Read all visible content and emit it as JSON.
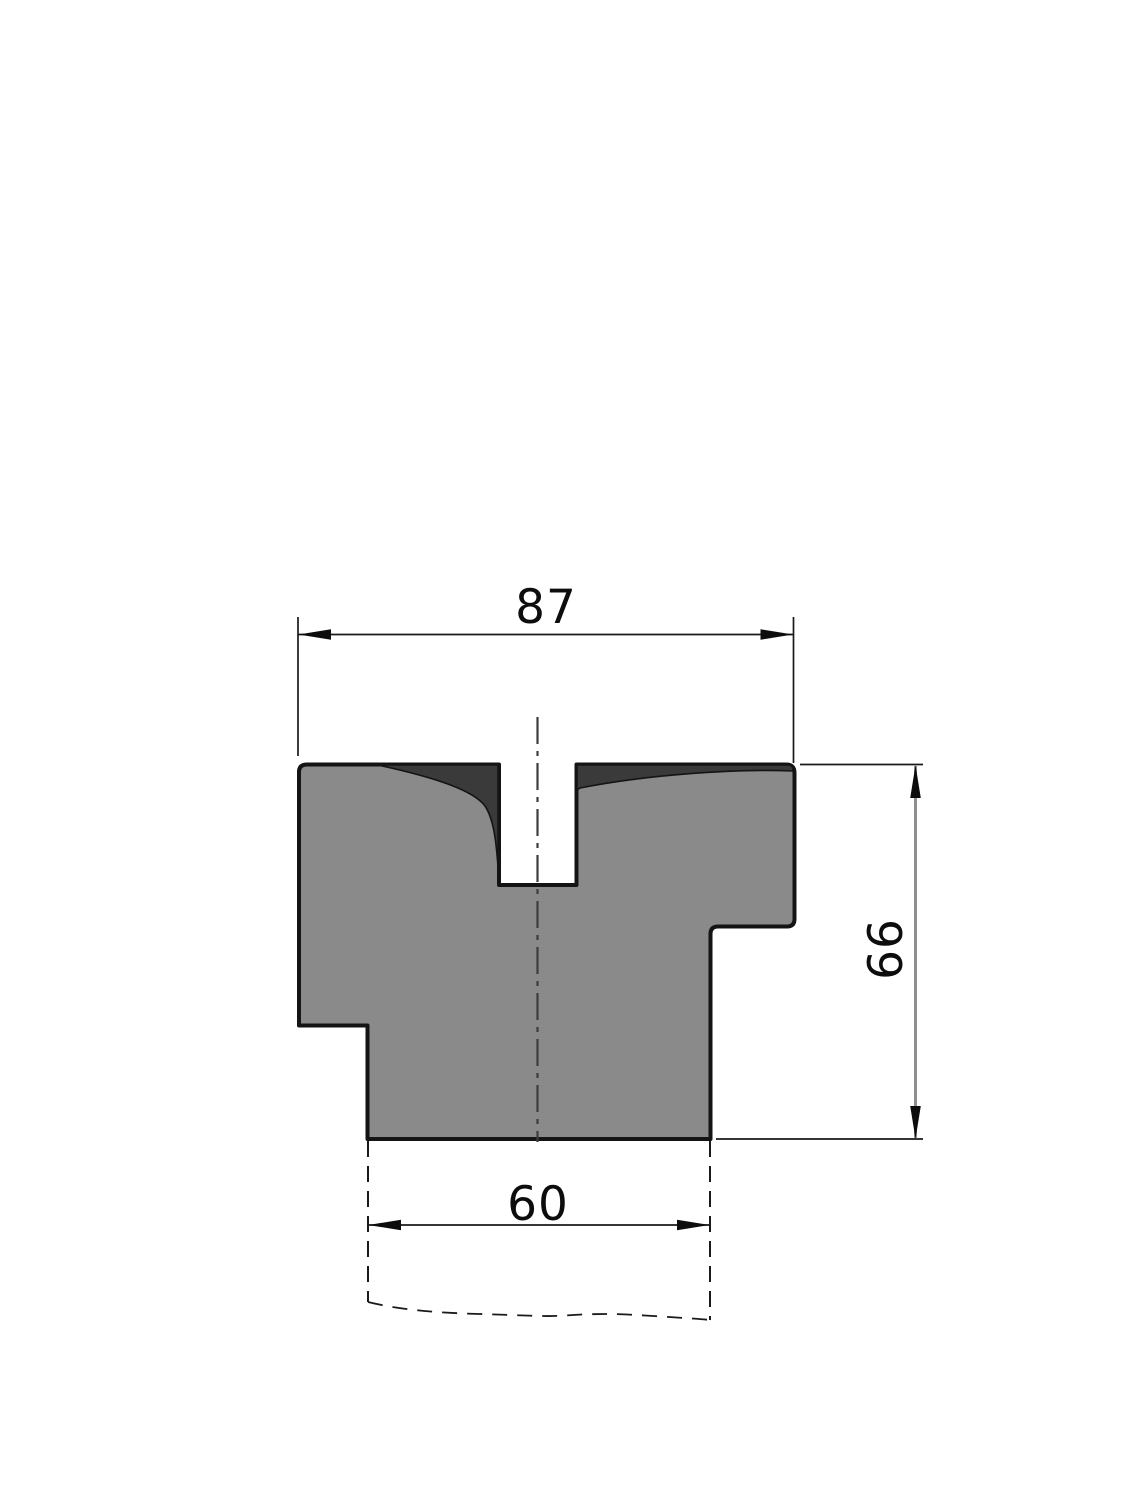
{
  "drawing": {
    "dimensions": {
      "top_width": "87",
      "height": "66",
      "bottom_width": "60"
    },
    "colors": {
      "background": "#ffffff",
      "body_fill": "#8a8a8a",
      "hardened_zone_fill": "#3a3a3a",
      "outline": "#141414",
      "dim_line_gray": "#8f8f8f"
    }
  }
}
